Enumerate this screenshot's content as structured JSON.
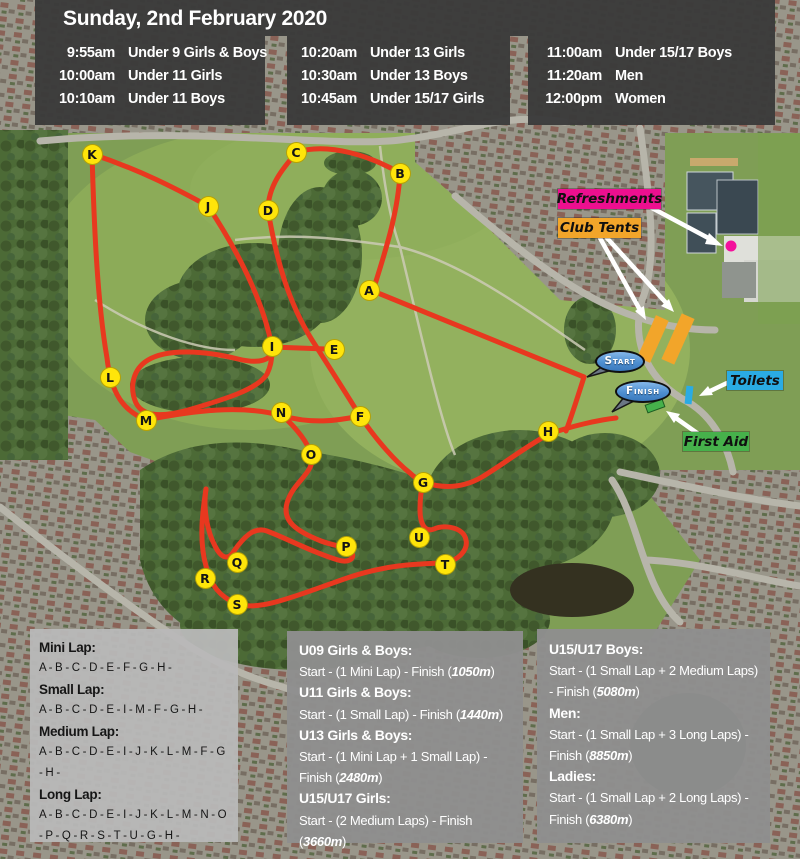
{
  "title": "Sunday, 2nd February 2020",
  "schedule": [
    [
      {
        "time": "9:55am",
        "event": "Under 9 Girls & Boys"
      },
      {
        "time": "10:00am",
        "event": "Under 11 Girls"
      },
      {
        "time": "10:10am",
        "event": "Under 11 Boys"
      }
    ],
    [
      {
        "time": "10:20am",
        "event": "Under 13 Girls"
      },
      {
        "time": "10:30am",
        "event": "Under 13 Boys"
      },
      {
        "time": "10:45am",
        "event": "Under 15/17 Girls"
      }
    ],
    [
      {
        "time": "11:00am",
        "event": "Under 15/17 Boys"
      },
      {
        "time": "11:20am",
        "event": "Men"
      },
      {
        "time": "12:00pm",
        "event": "Women"
      }
    ]
  ],
  "map": {
    "colors": {
      "route": "#e8381f",
      "marker_bg": "#ffe50a",
      "marker_text": "#151515",
      "refreshments": "#ed0f8f",
      "club_tents": "#f2a52a",
      "toilets": "#2aabe3",
      "first_aid": "#46b14b"
    },
    "markers": [
      {
        "label": "A",
        "x": 369,
        "y": 290
      },
      {
        "label": "B",
        "x": 400,
        "y": 173
      },
      {
        "label": "C",
        "x": 296,
        "y": 152
      },
      {
        "label": "D",
        "x": 268,
        "y": 210
      },
      {
        "label": "E",
        "x": 334,
        "y": 349
      },
      {
        "label": "F",
        "x": 360,
        "y": 416
      },
      {
        "label": "G",
        "x": 423,
        "y": 482
      },
      {
        "label": "H",
        "x": 548,
        "y": 431
      },
      {
        "label": "I",
        "x": 272,
        "y": 346
      },
      {
        "label": "J",
        "x": 208,
        "y": 206
      },
      {
        "label": "K",
        "x": 92,
        "y": 154
      },
      {
        "label": "L",
        "x": 110,
        "y": 377
      },
      {
        "label": "M",
        "x": 146,
        "y": 420
      },
      {
        "label": "N",
        "x": 281,
        "y": 412
      },
      {
        "label": "O",
        "x": 311,
        "y": 454
      },
      {
        "label": "P",
        "x": 346,
        "y": 546
      },
      {
        "label": "Q",
        "x": 237,
        "y": 562
      },
      {
        "label": "R",
        "x": 205,
        "y": 578
      },
      {
        "label": "S",
        "x": 237,
        "y": 604
      },
      {
        "label": "T",
        "x": 445,
        "y": 564
      },
      {
        "label": "U",
        "x": 419,
        "y": 537
      }
    ],
    "poi_labels": [
      {
        "id": "refreshments",
        "text": "Refreshments",
        "bg": "#ed0f8f",
        "x": 558,
        "y": 189,
        "w": 103,
        "h": 20
      },
      {
        "id": "club-tents",
        "text": "Club Tents",
        "bg": "#f2a52a",
        "x": 558,
        "y": 218,
        "w": 83,
        "h": 20
      },
      {
        "id": "toilets",
        "text": "Toilets",
        "bg": "#2aabe3",
        "x": 727,
        "y": 371,
        "w": 56,
        "h": 19
      },
      {
        "id": "first-aid",
        "text": "First Aid",
        "bg": "#46b14b",
        "x": 683,
        "y": 432,
        "w": 66,
        "h": 19
      }
    ],
    "bubbles": [
      {
        "id": "start",
        "text": "Start",
        "cx": 618,
        "cy": 361,
        "w": 46,
        "h": 19
      },
      {
        "id": "finish",
        "text": "Finish",
        "cx": 641,
        "cy": 391,
        "w": 52,
        "h": 19
      }
    ]
  },
  "laps": {
    "items": [
      {
        "name": "Mini Lap:",
        "sequence": "A - B - C - D - E - F - G - H -"
      },
      {
        "name": "Small Lap:",
        "sequence": "A - B - C - D - E - I - M - F - G - H -"
      },
      {
        "name": "Medium Lap:",
        "sequence": "A - B - C - D - E - I - J - K - L - M - F - G - H -"
      },
      {
        "name": "Long Lap:",
        "sequence": "A - B - C - D - E - I - J - K - L - M - N - O - P - Q - R - S - T - U - G - H -"
      }
    ]
  },
  "races": {
    "middle": [
      {
        "name": "U09 Girls & Boys:",
        "desc": "Start - (1 Mini Lap) - Finish ",
        "distance": "1050m"
      },
      {
        "name": "U11 Girls & Boys:",
        "desc": "Start - (1 Small Lap) - Finish ",
        "distance": "1440m"
      },
      {
        "name": "U13 Girls & Boys:",
        "desc": "Start - (1 Mini Lap + 1 Small Lap) - Finish ",
        "distance": "2480m"
      },
      {
        "name": "U15/U17 Girls:",
        "desc": "Start - (2 Medium Laps) - Finish ",
        "distance": "3660m"
      }
    ],
    "right": [
      {
        "name": "U15/U17 Boys:",
        "desc": "Start - (1 Small Lap + 2 Medium Laps) - Finish ",
        "distance": "5080m"
      },
      {
        "name": "Men:",
        "desc": "Start - (1 Small Lap + 3 Long Laps) - Finish ",
        "distance": "8850m"
      },
      {
        "name": "Ladies:",
        "desc": "Start - (1 Small Lap + 2 Long Laps) - Finish ",
        "distance": "6380m"
      }
    ]
  },
  "punctuation": {
    "open": "(",
    "close": ")"
  }
}
